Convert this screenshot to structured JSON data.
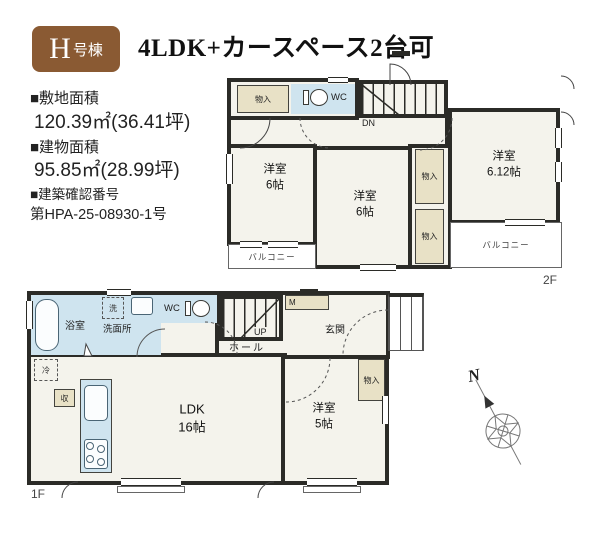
{
  "colors": {
    "wall": "#2b2b27",
    "room_fill": "#f4f3ec",
    "water_fill": "#cfe4ef",
    "closet_fill": "#e8e1c6",
    "badge_brown": "#8a5a33"
  },
  "header": {
    "badge_main": "H",
    "badge_sub": "号棟",
    "title": "4LDK+カースペース2台可"
  },
  "info": {
    "items": [
      {
        "label": "■敷地面積",
        "value": "120.39㎡(36.41坪)"
      },
      {
        "label": "■建物面積",
        "value": "95.85㎡(28.99坪)"
      },
      {
        "label": "■建築確認番号",
        "value": "第HPA-25-08930-1号"
      }
    ]
  },
  "floor2": {
    "floor_label": "2F",
    "closet_top": "物入",
    "wc": "WC",
    "dn": "DN",
    "room_left": "洋室\n6帖",
    "room_mid": "洋室\n6帖",
    "room_right": "洋室\n6.12帖",
    "closet_1": "物入",
    "closet_2": "物入",
    "balcony_left": "バルコニー",
    "balcony_right": "バルコニー"
  },
  "floor1": {
    "floor_label": "1F",
    "bath": "浴室",
    "laundry": "洗",
    "washroom": "洗面所",
    "wc": "WC",
    "hall": "ホール",
    "up": "UP",
    "meter": "M",
    "entrance": "玄関",
    "closet": "物入",
    "fridge": "冷",
    "storage": "収",
    "ldk": "LDK\n16帖",
    "room": "洋室\n5帖"
  },
  "compass": {
    "north": "N"
  }
}
